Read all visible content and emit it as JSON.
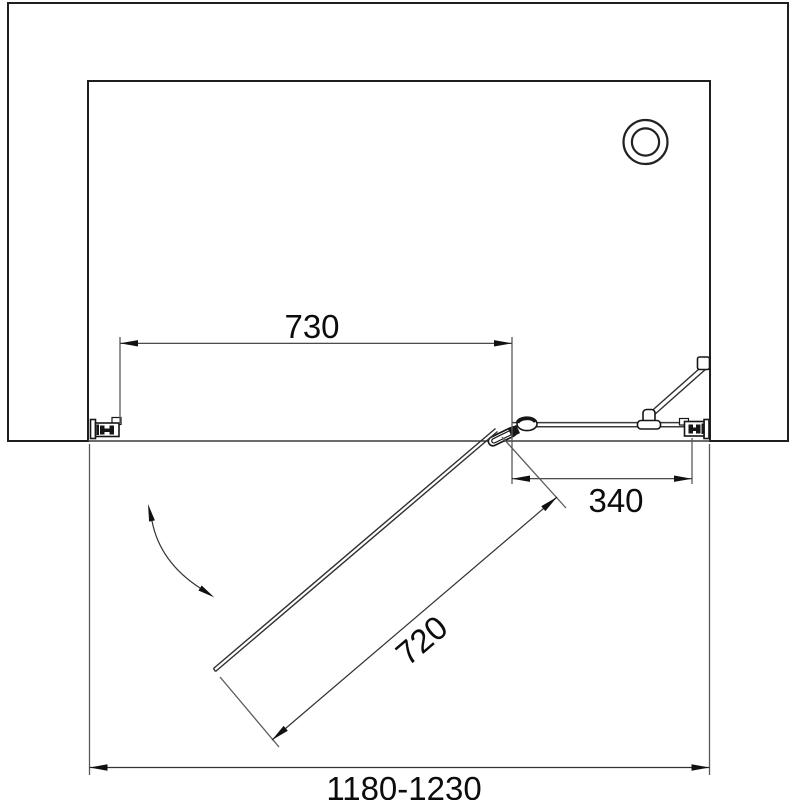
{
  "drawing": {
    "kind": "shower-enclosure-top-view-dimension-drawing",
    "dimensions": {
      "door_opening_width": "730",
      "fixed_panel_width": "340",
      "door_panel_width": "720",
      "overall_width_range": "1180-1230"
    },
    "colors": {
      "background": "#ffffff",
      "outline": "#1f1f1f",
      "hatch": "#3c3c3c",
      "dimension_line": "#333333",
      "extension_line": "#5a5a5a",
      "text": "#0c0c0c"
    }
  }
}
